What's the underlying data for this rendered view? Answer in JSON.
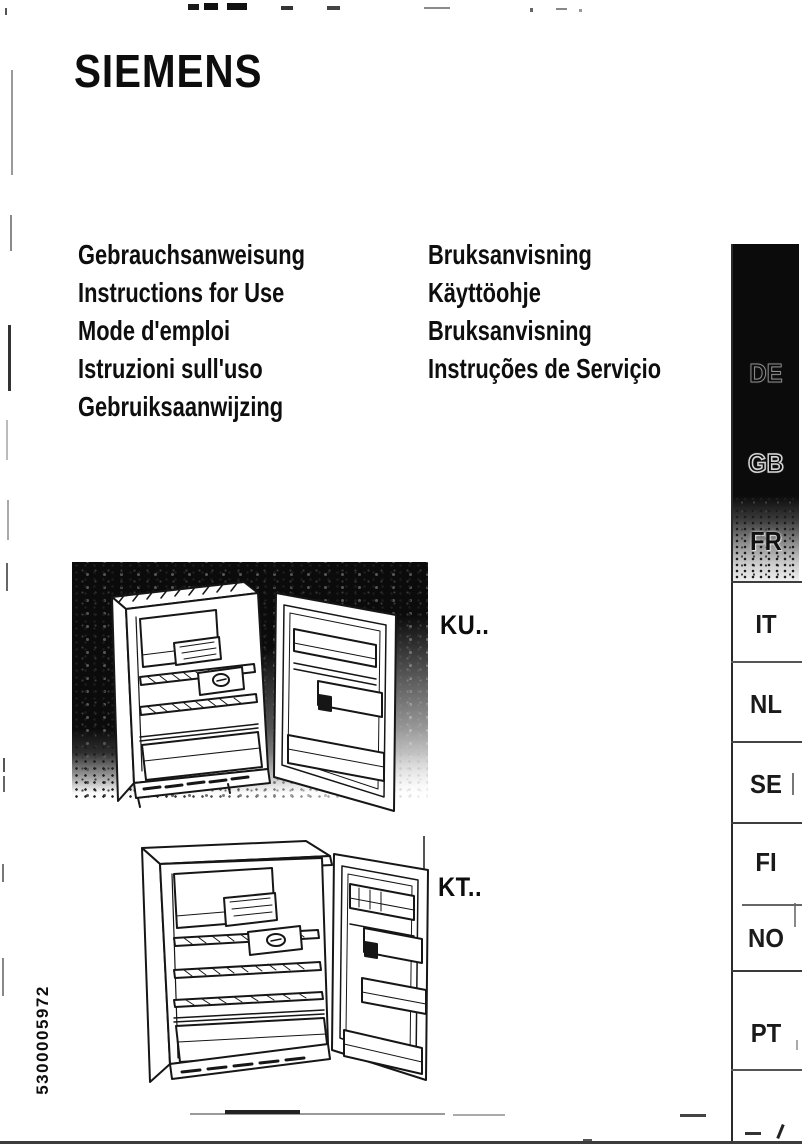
{
  "brand": "SIEMENS",
  "serial_number": "5300005972",
  "titles": {
    "left": [
      "Gebrauchsanweisung",
      "Instructions for Use",
      "Mode d'emploi",
      "Istruzioni sull'uso",
      "Gebruiksaanwijzing"
    ],
    "right": [
      "Bruksanvisning",
      "Käyttöohje",
      "Bruksanvisning",
      "Instruções de Serviçio"
    ]
  },
  "models": [
    {
      "label": "KU.."
    },
    {
      "label": "KT.."
    }
  ],
  "language_tabs": [
    {
      "code": "DE"
    },
    {
      "code": "GB"
    },
    {
      "code": "FR"
    },
    {
      "code": "IT"
    },
    {
      "code": "NL"
    },
    {
      "code": "SE"
    },
    {
      "code": "FI"
    },
    {
      "code": "NO"
    },
    {
      "code": "PT"
    }
  ],
  "colors": {
    "ink": "#141414",
    "paper": "#ffffff",
    "photo_background": "#0b0b0b",
    "sidebar_black": "#0b0b0b"
  }
}
